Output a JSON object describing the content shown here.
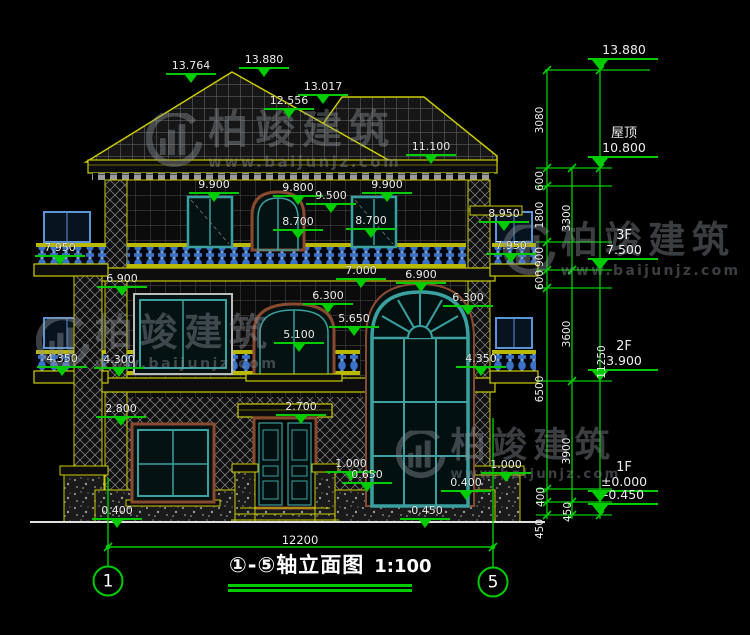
{
  "drawing": {
    "title": "①-⑤轴立面图",
    "scale": "1:100",
    "overall_width_dim": "12200",
    "axis_bubbles": [
      {
        "label": "1",
        "x": 108,
        "y": 581
      },
      {
        "label": "5",
        "x": 493,
        "y": 582
      }
    ],
    "elevation_markers": [
      {
        "t": "13.764",
        "x": 191,
        "y": 60
      },
      {
        "t": "13.880",
        "x": 264,
        "y": 54
      },
      {
        "t": "12.556",
        "x": 289,
        "y": 95
      },
      {
        "t": "13.017",
        "x": 323,
        "y": 81
      },
      {
        "t": "11.100",
        "x": 431,
        "y": 141
      },
      {
        "t": "9.900",
        "x": 214,
        "y": 179
      },
      {
        "t": "9.800",
        "x": 298,
        "y": 182
      },
      {
        "t": "9.500",
        "x": 331,
        "y": 190
      },
      {
        "t": "9.900",
        "x": 387,
        "y": 179
      },
      {
        "t": "8.700",
        "x": 298,
        "y": 216
      },
      {
        "t": "8.700",
        "x": 371,
        "y": 215
      },
      {
        "t": "8.950",
        "x": 504,
        "y": 208
      },
      {
        "t": "7.950",
        "x": 60,
        "y": 242
      },
      {
        "t": "7.950",
        "x": 511,
        "y": 240
      },
      {
        "t": "7.000",
        "x": 361,
        "y": 265
      },
      {
        "t": "6.900",
        "x": 122,
        "y": 273
      },
      {
        "t": "6.900",
        "x": 421,
        "y": 269
      },
      {
        "t": "6.300",
        "x": 328,
        "y": 290
      },
      {
        "t": "6.300",
        "x": 468,
        "y": 292
      },
      {
        "t": "5.650",
        "x": 354,
        "y": 313
      },
      {
        "t": "5.100",
        "x": 299,
        "y": 329
      },
      {
        "t": "4.350",
        "x": 62,
        "y": 353
      },
      {
        "t": "4.300",
        "x": 119,
        "y": 354
      },
      {
        "t": "4.350",
        "x": 481,
        "y": 353
      },
      {
        "t": "2.800",
        "x": 121,
        "y": 403
      },
      {
        "t": "2.700",
        "x": 301,
        "y": 401
      },
      {
        "t": "1.000",
        "x": 351,
        "y": 458
      },
      {
        "t": "0.650",
        "x": 367,
        "y": 469
      },
      {
        "t": "1.000",
        "x": 506,
        "y": 459
      },
      {
        "t": "0.400",
        "x": 466,
        "y": 477
      },
      {
        "t": "0.400",
        "x": 117,
        "y": 505
      },
      {
        "t": "-0.450",
        "x": 425,
        "y": 505
      }
    ],
    "floor_levels": [
      {
        "name": "",
        "val": "13.880",
        "y": 70
      },
      {
        "name": "屋顶",
        "val": "10.800",
        "y": 168
      },
      {
        "name": "3F",
        "val": "7.500",
        "y": 270
      },
      {
        "name": "2F",
        "val": "3.900",
        "y": 381
      },
      {
        "name": "1F",
        "val": "±0.000",
        "y": 502
      },
      {
        "name": "",
        "val": "-0.450",
        "y": 515
      }
    ],
    "dim_chain_labels": [
      {
        "t": "3080",
        "x": 540,
        "y": 120
      },
      {
        "t": "600",
        "x": 540,
        "y": 181
      },
      {
        "t": "1800",
        "x": 540,
        "y": 215
      },
      {
        "t": "900",
        "x": 540,
        "y": 257
      },
      {
        "t": "600",
        "x": 540,
        "y": 280
      },
      {
        "t": "6500",
        "x": 540,
        "y": 389
      },
      {
        "t": "400",
        "x": 541,
        "y": 497
      },
      {
        "t": "450",
        "x": 540,
        "y": 529
      },
      {
        "t": "3300",
        "x": 567,
        "y": 218
      },
      {
        "t": "3600",
        "x": 567,
        "y": 334
      },
      {
        "t": "3900",
        "x": 567,
        "y": 451
      },
      {
        "t": "450",
        "x": 568,
        "y": 512
      },
      {
        "t": "11250",
        "x": 602,
        "y": 362
      }
    ]
  },
  "watermark": {
    "brand": "柏竣建筑",
    "url": "www.baijunjz.com",
    "instances": [
      {
        "x": 146,
        "y": 110,
        "s": 1.0
      },
      {
        "x": 503,
        "y": 222,
        "s": 0.93
      },
      {
        "x": 36,
        "y": 314,
        "s": 0.95
      },
      {
        "x": 396,
        "y": 428,
        "s": 0.88
      }
    ]
  },
  "colors": {
    "background": "#000000",
    "cad_green": "#00cc00",
    "cad_yellow": "#cccc00",
    "text": "#ededed",
    "baluster_blue": "#4a86d8",
    "window_teal": "#3aa0a0",
    "frame_maroon": "#8a4a30"
  }
}
